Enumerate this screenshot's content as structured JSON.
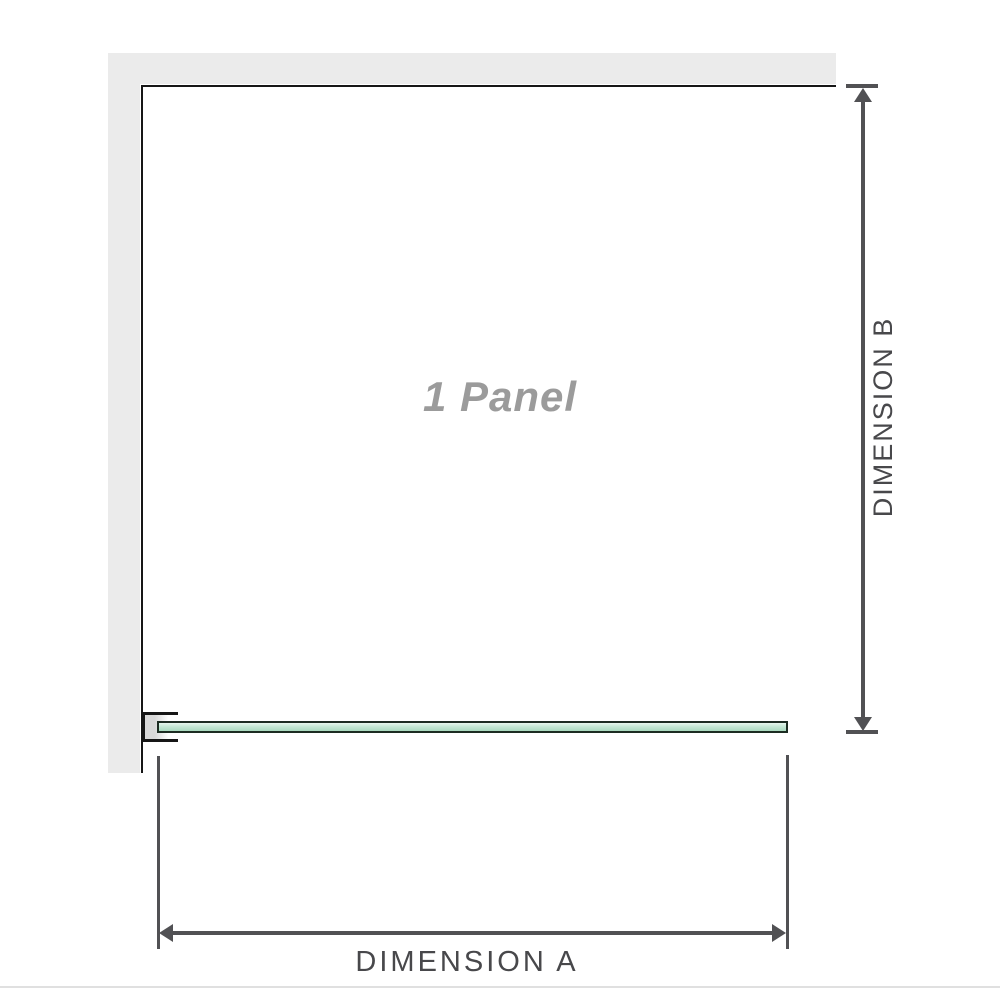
{
  "diagram": {
    "panel_label": "1 Panel",
    "dim_a": {
      "label": "DIMENSION A"
    },
    "dim_b": {
      "label": "DIMENSION B"
    },
    "colors": {
      "background": "#ffffff",
      "wall_fill": "#ebebeb",
      "wall_edge": "#161616",
      "glass_border": "#1c2c22",
      "glass_top": "#e7f6ee",
      "glass_mid": "#c4e7d4",
      "glass_bottom": "#a9d9bf",
      "bracket_fill_dark": "#d9d9d9",
      "bracket_fill_light": "#ffffff",
      "dim_line": "#515154",
      "dim_text": "#48484b",
      "panel_text": "#9b9b9b",
      "baseline": "#e0e0e0"
    }
  }
}
